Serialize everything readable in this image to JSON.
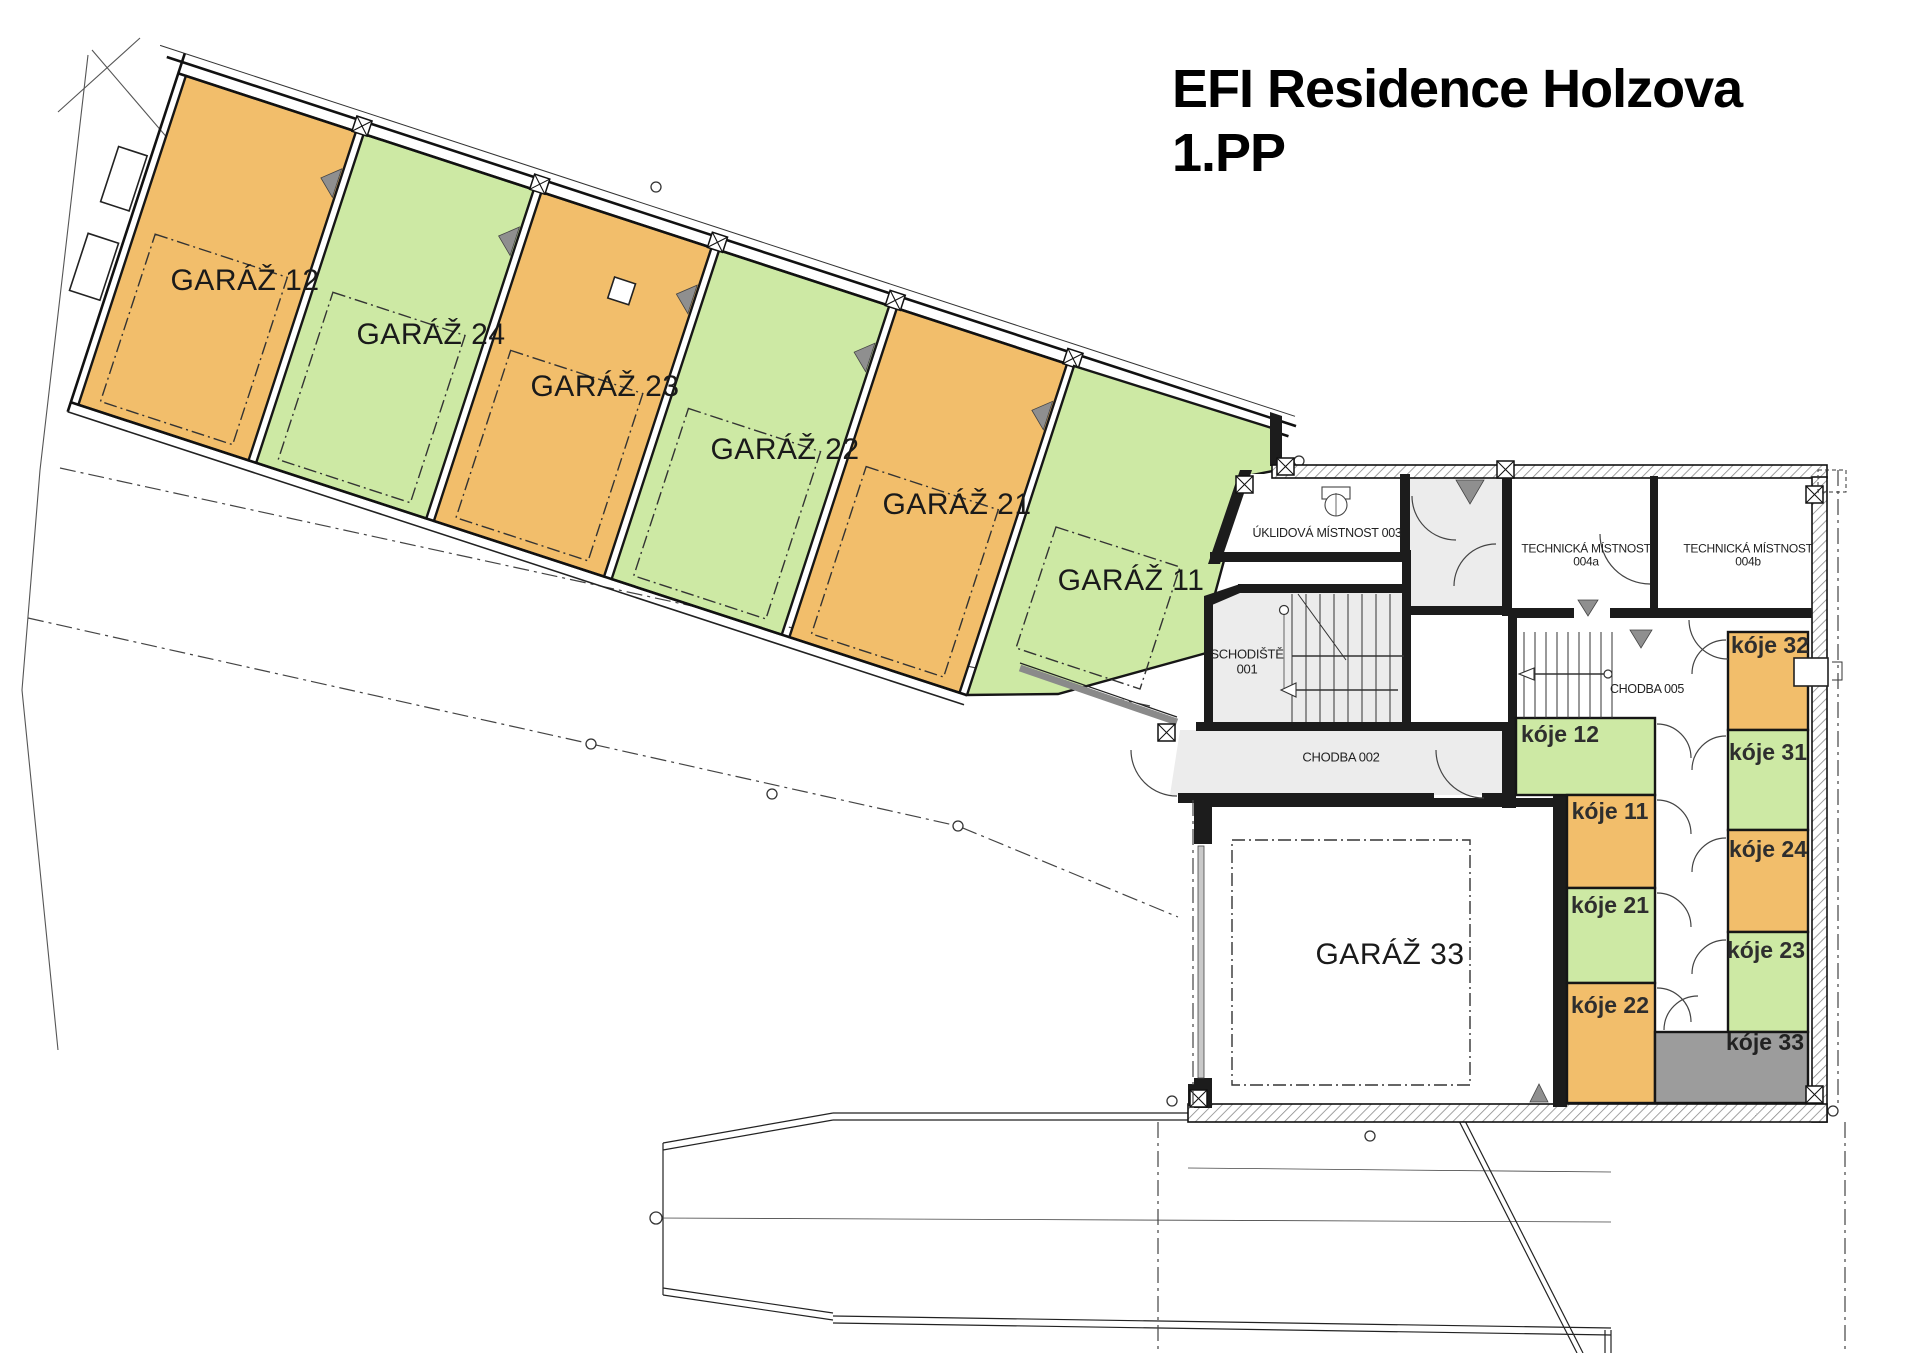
{
  "title": {
    "line1": "EFI Residence Holzova",
    "line2": "1.PP"
  },
  "colors": {
    "orange": "#f2be6b",
    "green": "#cde9a4",
    "room_gray": "#ececec",
    "koje_gray": "#9c9c9c",
    "wall": "#1a1a1a"
  },
  "garages": {
    "g12": "GARÁŽ 12",
    "g24": "GARÁŽ 24",
    "g23": "GARÁŽ 23",
    "g22": "GARÁŽ 22",
    "g21": "GARÁŽ 21",
    "g11": "GARÁŽ 11",
    "g33": "GARÁŽ 33"
  },
  "rooms": {
    "schodiste": "SCHODIŠTĚ\n001",
    "chodba002": "CHODBA 002",
    "uklidova": "ÚKLIDOVÁ MÍSTNOST 003",
    "technicka_a": "TECHNICKÁ MÍSTNOST\n004a",
    "technicka_b": "TECHNICKÁ MÍSTNOST\n004b",
    "chodba005": "CHODBA 005"
  },
  "koje": {
    "k12": "kóje 12",
    "k11": "kóje 11",
    "k21": "kóje 21",
    "k22": "kóje 22",
    "k32": "kóje 32",
    "k31": "kóje 31",
    "k24": "kóje 24",
    "k23": "kóje 23",
    "k33": "kóje 33"
  }
}
